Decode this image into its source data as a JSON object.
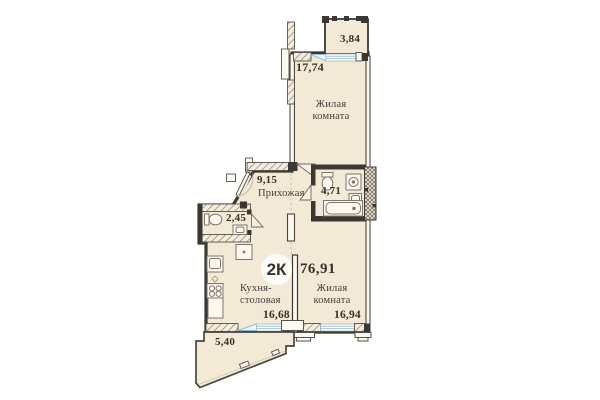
{
  "floorplan": {
    "badge": {
      "type": "2К",
      "total_area": "76,91"
    },
    "rooms": [
      {
        "id": "loggia-top",
        "name": "",
        "area": "3,84"
      },
      {
        "id": "living-top",
        "name": "Жилая комната",
        "name_lines": [
          "Жилая",
          "комната"
        ],
        "area": "17,74"
      },
      {
        "id": "hallway",
        "name": "Прихожая",
        "area": "9,15"
      },
      {
        "id": "bathroom",
        "name": "",
        "area": "4,71"
      },
      {
        "id": "wc",
        "name": "",
        "area": "2,45"
      },
      {
        "id": "kitchen-dining",
        "name": "Кухня-столовая",
        "name_lines": [
          "Кухня-",
          "столовая"
        ],
        "area": "16,68"
      },
      {
        "id": "living-bottom",
        "name": "Жилая комната",
        "name_lines": [
          "Жилая",
          "комната"
        ],
        "area": "16,94"
      },
      {
        "id": "balcony-bottom",
        "name": "",
        "area": "5,40"
      }
    ],
    "colors": {
      "room_fill": "#f3e9d7",
      "wall": "#3b3833",
      "window_glazing": "#8fbcdc",
      "text": "#37322b",
      "background": "#ffffff"
    }
  }
}
